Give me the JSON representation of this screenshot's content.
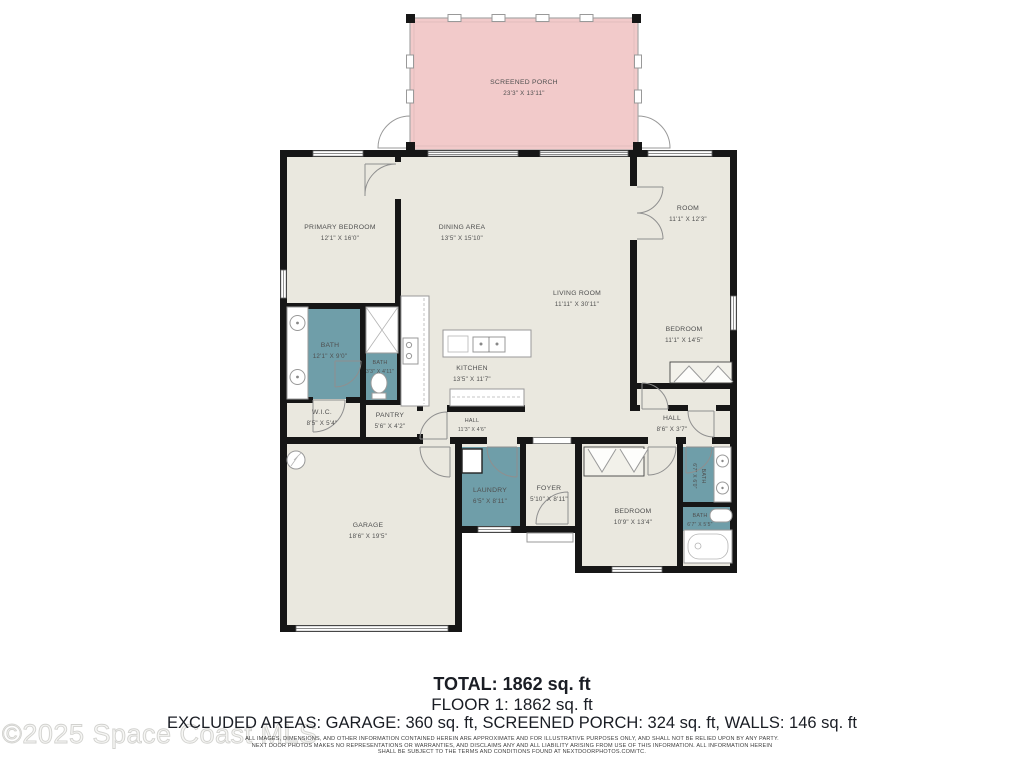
{
  "floorplan": {
    "rooms": {
      "screened_porch": {
        "name": "SCREENED PORCH",
        "dims": "23'3\" X 13'11\""
      },
      "primary_bedroom": {
        "name": "PRIMARY BEDROOM",
        "dims": "12'1\" X 16'0\""
      },
      "dining_area": {
        "name": "DINING AREA",
        "dims": "13'5\" X 15'10\""
      },
      "room": {
        "name": "ROOM",
        "dims": "11'1\" X 12'3\""
      },
      "living_room": {
        "name": "LIVING ROOM",
        "dims": "11'11\" X 30'11\""
      },
      "bedroom_right": {
        "name": "BEDROOM",
        "dims": "11'1\" X 14'5\""
      },
      "bath_primary": {
        "name": "BATH",
        "dims": "12'1\" X 9'0\""
      },
      "bath_small": {
        "name": "BATH",
        "dims": "3'3\" X 4'11\""
      },
      "kitchen": {
        "name": "KITCHEN",
        "dims": "13'5\" X 11'7\""
      },
      "wic": {
        "name": "W.I.C.",
        "dims": "8'5\" X 5'4\""
      },
      "pantry": {
        "name": "PANTRY",
        "dims": "5'6\" X 4'2\""
      },
      "hall_center": {
        "name": "HALL",
        "dims": "11'3\" X 4'6\""
      },
      "hall_right": {
        "name": "HALL",
        "dims": "8'6\" X 3'7\""
      },
      "garage": {
        "name": "GARAGE",
        "dims": "18'6\" X 19'5\""
      },
      "laundry": {
        "name": "LAUNDRY",
        "dims": "6'5\" X 8'11\""
      },
      "foyer": {
        "name": "FOYER",
        "dims": "5'10\" X 8'11\""
      },
      "bedroom_bottom": {
        "name": "BEDROOM",
        "dims": "10'9\" X 13'4\""
      },
      "bath_ensuite": {
        "name": "BATH",
        "dims": "6'7\" X 6'0\""
      },
      "bath_lower": {
        "name": "BATH",
        "dims": "6'7\" X 5'5\""
      }
    },
    "colors": {
      "floor": "#eae8df",
      "porch": "#f2caca",
      "wet_room": "#6f9ea9",
      "wall": "#161616"
    }
  },
  "summary": {
    "total": "TOTAL: 1862 sq. ft",
    "floor1": "FLOOR 1: 1862 sq. ft",
    "excluded": "EXCLUDED AREAS: GARAGE: 360 sq. ft, SCREENED PORCH: 324 sq. ft, WALLS: 146 sq. ft"
  },
  "watermark": "©2025 Space Coast MLS",
  "disclaimer": {
    "line1": "ALL IMAGES, DIMENSIONS, AND OTHER INFORMATION CONTAINED HEREIN ARE APPROXIMATE AND FOR ILLUSTRATIVE PURPOSES ONLY, AND SHALL NOT BE RELIED UPON BY ANY PARTY.",
    "line2": "NEXT DOOR PHOTOS MAKES NO REPRESENTATIONS OR WARRANTIES, AND DISCLAIMS ANY AND ALL LIABILITY ARISING FROM USE OF THIS INFORMATION. ALL INFORMATION HEREIN",
    "line3": "SHALL BE SUBJECT TO THE TERMS AND CONDITIONS FOUND AT NEXTDOORPHOTOS.COM/TC."
  }
}
